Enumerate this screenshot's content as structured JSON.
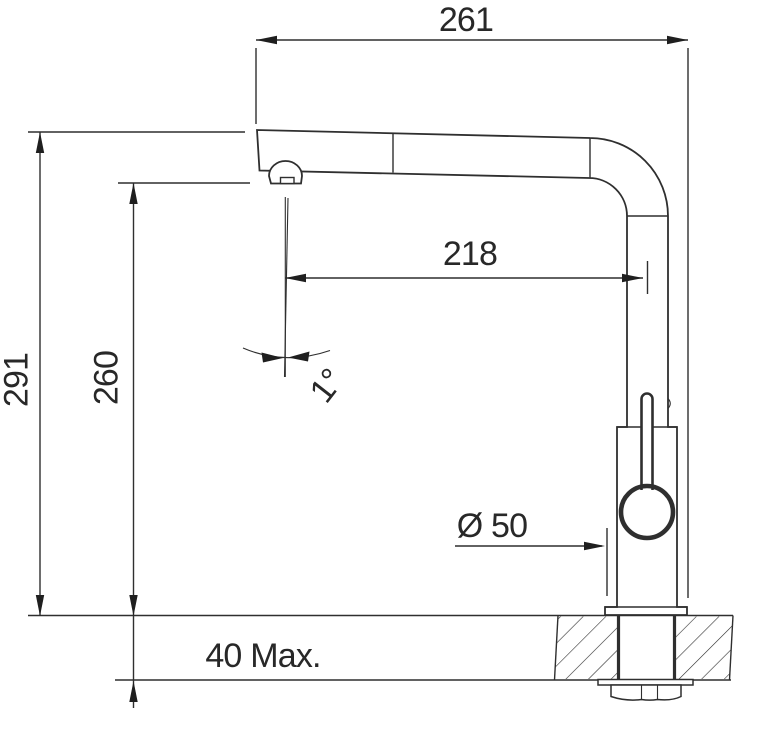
{
  "drawing": {
    "colors": {
      "line": "#2f2f2f",
      "text": "#282828",
      "background": "#ffffff"
    },
    "labels": {
      "top_width": "261",
      "overall_height": "291",
      "spout_height": "260",
      "stream_offset": "218",
      "stream_angle": "1°",
      "base_diameter": "Ø 50",
      "counter_thickness": "40 Max."
    }
  }
}
